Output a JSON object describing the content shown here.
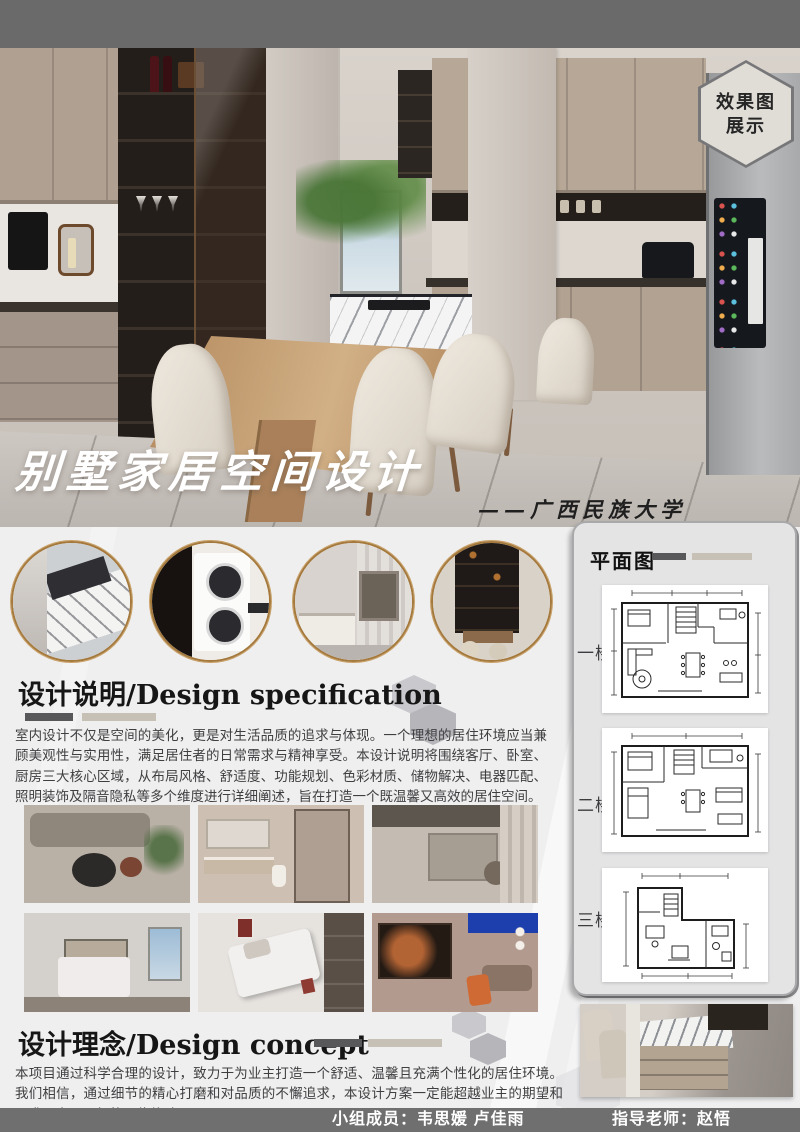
{
  "badge": {
    "line1": "效果图",
    "line2": "展示"
  },
  "hero": {
    "title": "别墅家居空间设计",
    "subtitle": "——广西民族大学"
  },
  "floorplan": {
    "title": "平面图",
    "floors": [
      {
        "label": "一楼"
      },
      {
        "label": "二楼"
      },
      {
        "label": "三楼"
      }
    ]
  },
  "spec": {
    "heading": "设计说明/Design specification",
    "body": "室内设计不仅是空间的美化，更是对生活品质的追求与体现。一个理想的居住环境应当兼顾美观性与实用性，满足居住者的日常需求与精神享受。本设计说明将围绕客厅、卧室、厨房三大核心区域，从布局风格、舒适度、功能规划、色彩材质、储物解决、电器匹配、照明装饰及隔音隐私等多个维度进行详细阐述，旨在打造一个既温馨又高效的居住空间。"
  },
  "concept": {
    "heading": "设计理念/Design concept",
    "body": "本项目通过科学合理的设计，致力于为业主打造一个舒适、温馨且充满个性化的居住环境。我们相信，通过细节的精心打磨和对品质的不懈追求，本设计方案一定能超越业主的期望和需求，实现理想的居住体验。"
  },
  "footer": {
    "members_label": "小组成员：韦思媛 卢佳雨",
    "advisor_label": "指导老师：赵悟"
  },
  "colors": {
    "accent_gold": "#a5793c",
    "bar_dark": "#58585a",
    "bar_beige": "#c7c1b5",
    "top_bar": "#6a6a6b",
    "bottom_bar": "#6f6f70"
  }
}
